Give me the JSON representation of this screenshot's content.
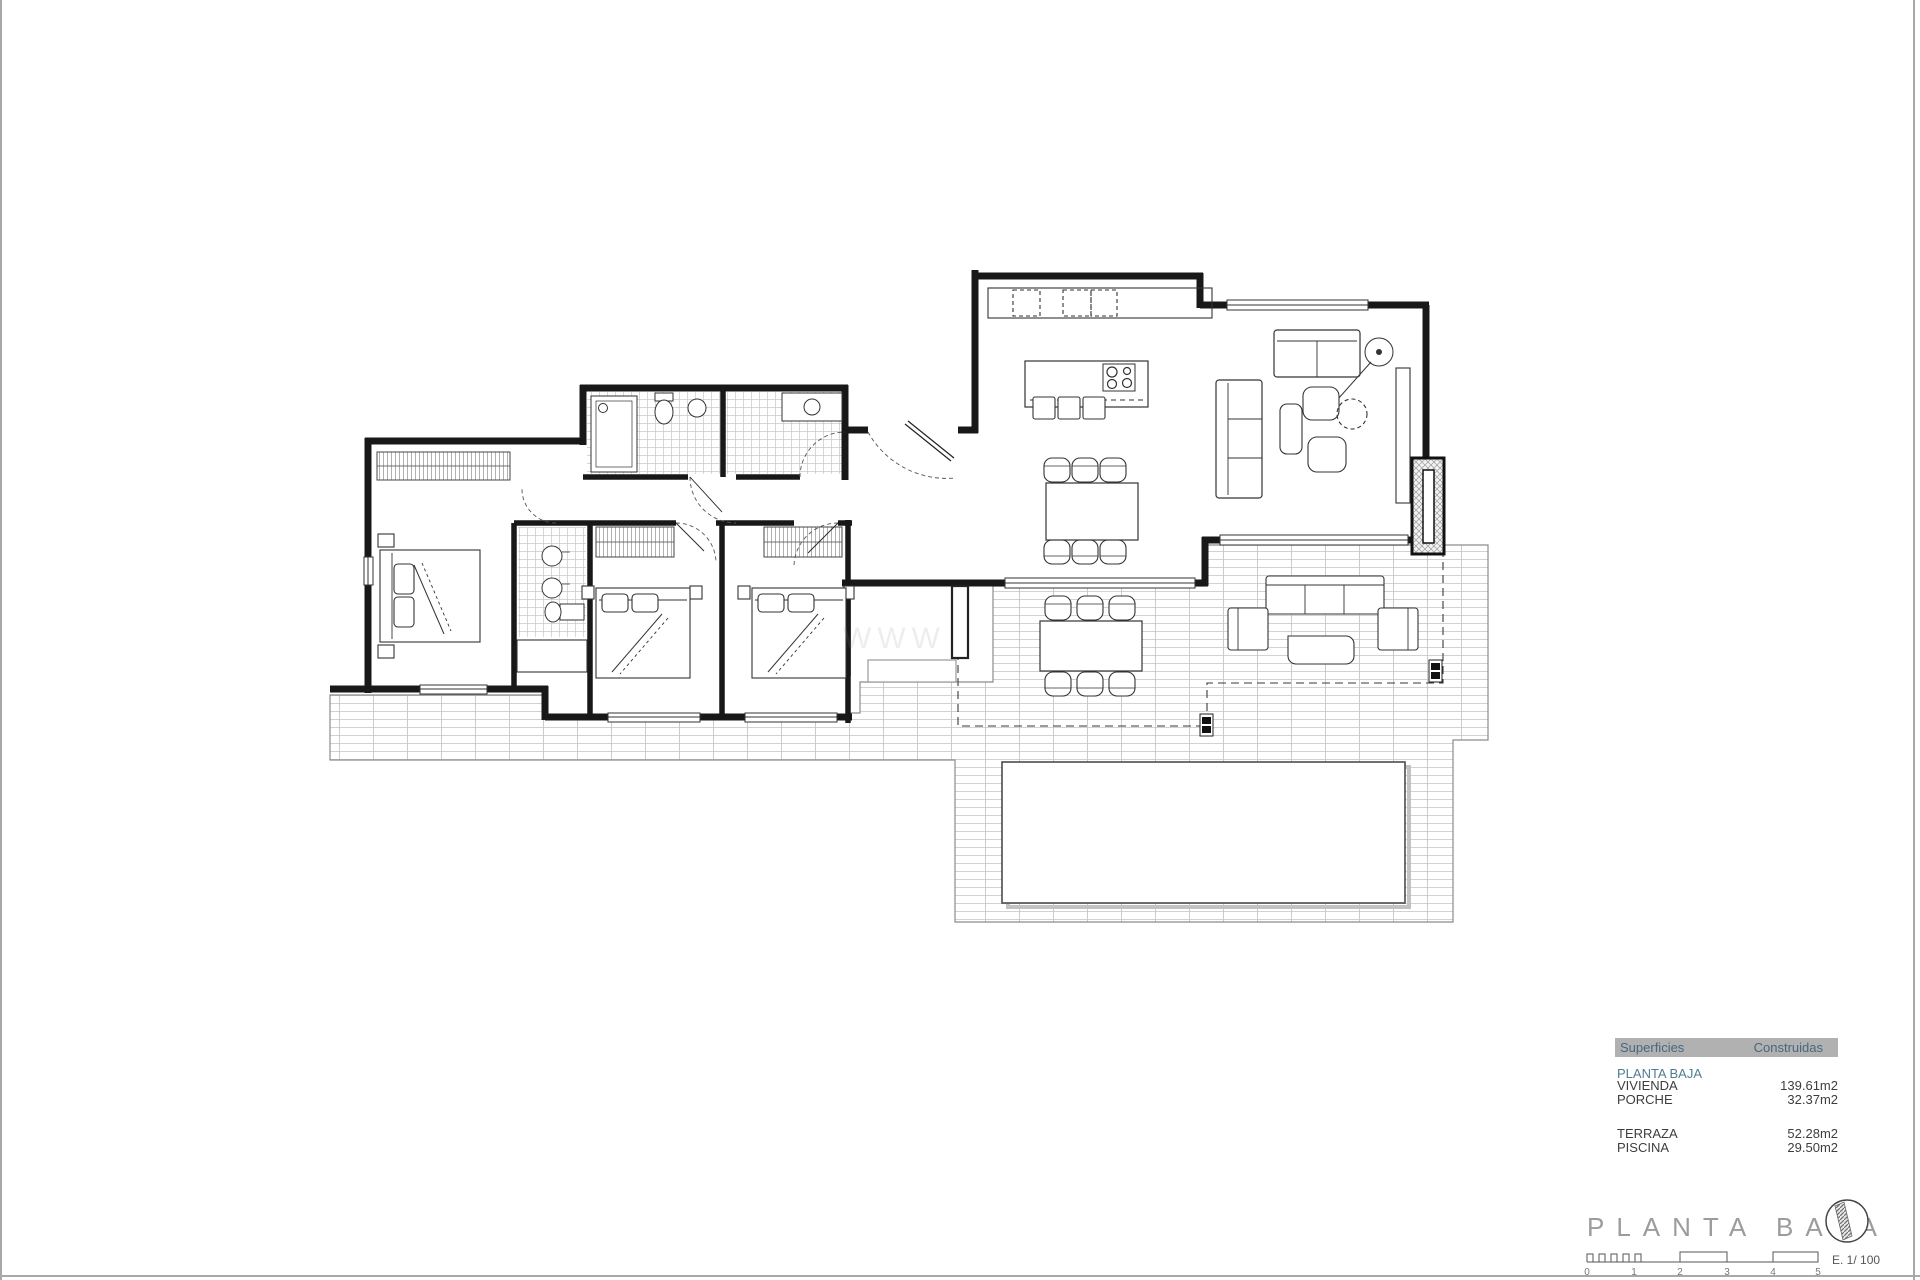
{
  "sheet": {
    "bg": "#ffffff",
    "border_color": "#a8a8a8"
  },
  "watermark": {
    "text": "WWW",
    "color": "#b0b0b0"
  },
  "plan": {
    "wall_color": "#181818",
    "tile_line_color": "#cfcfcf",
    "dash_color": "#3a3a3a",
    "pool_border": "#555555"
  },
  "legend_table": {
    "header": {
      "superficies": "Superficies",
      "construidas": "Construidas",
      "bg": "#b1b1b1",
      "text_color": "#45687e"
    },
    "section": "PLANTA BAJA",
    "rows": [
      {
        "label": "VIVIENDA",
        "value": "139.61m2"
      },
      {
        "label": "PORCHE",
        "value": "32.37m2"
      },
      {
        "label": "TERRAZA",
        "value": "52.28m2"
      },
      {
        "label": "PISCINA",
        "value": "29.50m2"
      }
    ],
    "section_color": "#4e7d91",
    "row_color": "#3d3d3d"
  },
  "title_block": {
    "title": "PLANTA  BAJA",
    "title_color": "#9c9c9c",
    "scale_text": "E. 1/ 100",
    "ticks": [
      "0",
      "1",
      "2",
      "3",
      "4",
      "5"
    ]
  }
}
